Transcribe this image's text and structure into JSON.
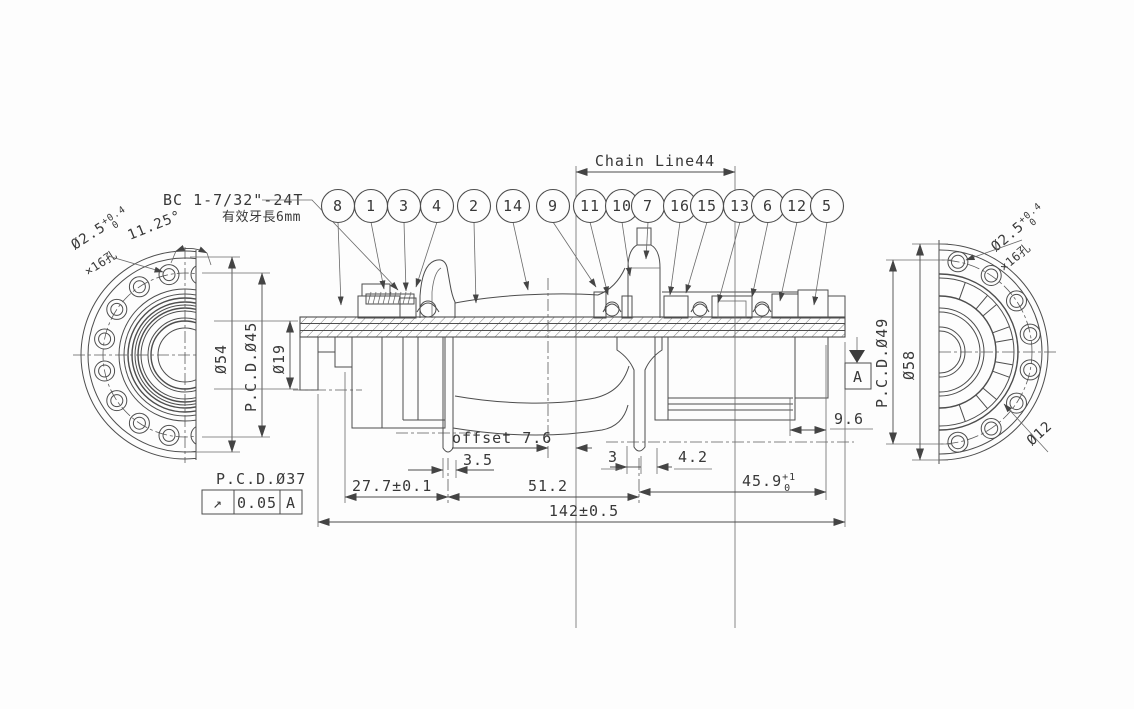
{
  "drawing": {
    "thread_spec": "BC 1-7/32\"-24T",
    "thread_note": "有效牙長6mm",
    "chain_line_label": "Chain Line44"
  },
  "balloons": [
    "8",
    "1",
    "3",
    "4",
    "2",
    "14",
    "9",
    "11",
    "10",
    "7",
    "16",
    "15",
    "13",
    "6",
    "12",
    "5"
  ],
  "left_view": {
    "dia_flange": "Ø54",
    "pcd": "P.C.D.Ø45",
    "dia_bore": "Ø19",
    "pcd_rotor": "P.C.D.Ø37",
    "hole_angle": "11.25°",
    "hole_dia": "Ø2.5",
    "hole_tol_up": "+0.4",
    "hole_tol_dn": "0",
    "hole_count": "×16孔"
  },
  "right_view": {
    "dia_flange": "Ø58",
    "pcd": "P.C.D.Ø49",
    "dia_center": "Ø12",
    "hole_dia": "Ø2.5",
    "hole_tol_up": "+0.4",
    "hole_tol_dn": "0",
    "hole_count": "×16孔"
  },
  "dims": {
    "offset": "offset 7.6",
    "flange_thickness": "3.5",
    "web": "3",
    "offset_r": "4.2",
    "end_gap": "9.6",
    "left_span": "27.7±0.1",
    "center_span": "51.2",
    "right_span": "45.9",
    "right_span_sup": "+1",
    "right_span_sub": "0",
    "overall": "142±0.5"
  },
  "tolerance_frame": {
    "symbol": "↗",
    "value": "0.05",
    "datum": "A"
  },
  "datum_flag": {
    "label": "A"
  }
}
